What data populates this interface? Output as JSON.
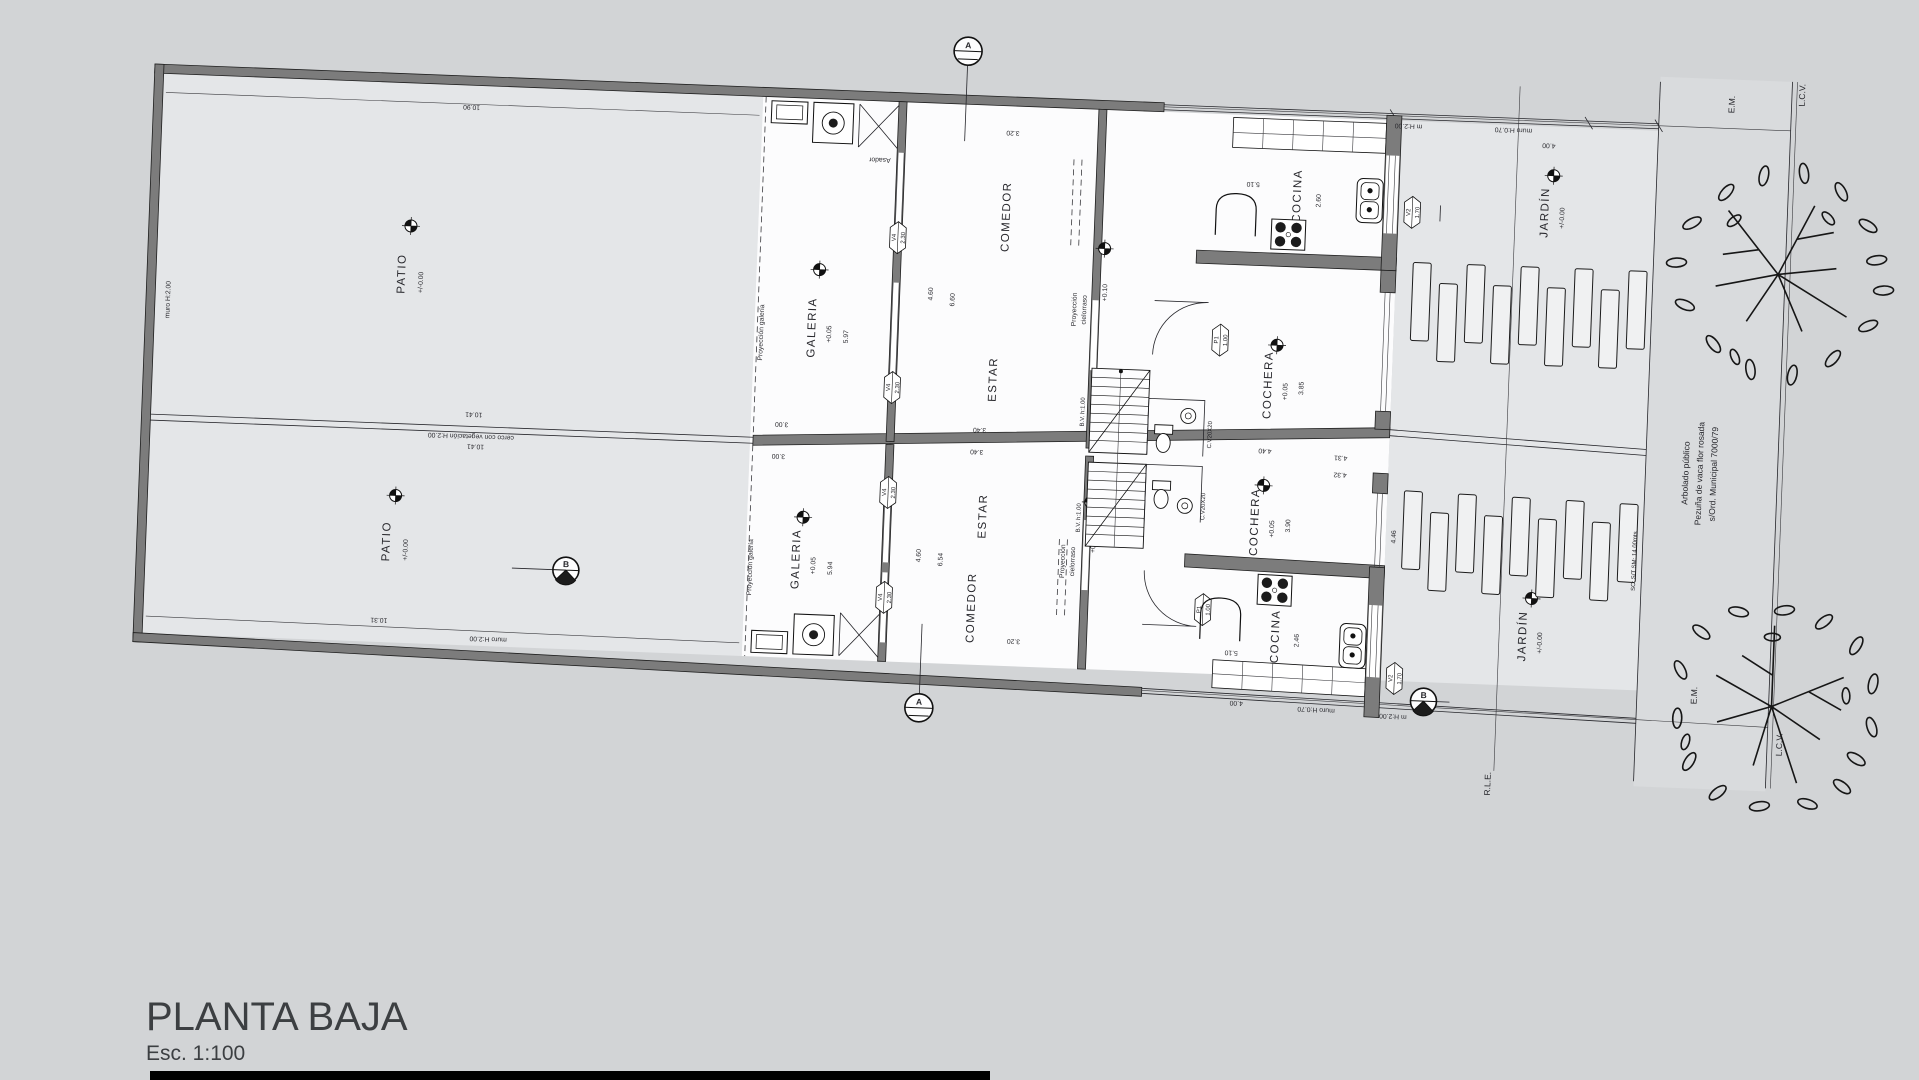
{
  "colors": {
    "background": "#d2d4d6",
    "paper": "#fcfcfd",
    "patio_fill": "#e4e6e8",
    "sidewalk_fill": "#d9dbdd",
    "wall": "#7c7c7c",
    "line": "#26262b"
  },
  "titleblock": {
    "title": "PLANTA BAJA",
    "scale": "Esc. 1:100"
  },
  "t": {
    "patio1": "PATIO",
    "patio2": "PATIO",
    "patio1_lvl": "+/-0.00",
    "patio2_lvl": "+/-0.00",
    "muro_left": "muro H:2.00",
    "muro_bottom": "muro H:2.00",
    "cerco": "cerco con vegetación H:2.00",
    "d1090": "10.90",
    "d1041a": "10.41",
    "d1041b": "10.41",
    "d1031": "10.31",
    "proy_gal1": "Proyección galería",
    "proy_gal2": "Proyección galería",
    "galeria1": "GALERIA",
    "galeria2": "GALERIA",
    "gal1_lvl": "+0.05",
    "gal2_lvl": "+0.05",
    "d597": "5.97",
    "d594": "5.94",
    "d300a": "3.00",
    "d300b": "3.00",
    "asador": "Asador",
    "comedor1": "COMEDOR",
    "comedor2": "COMEDOR",
    "estar1": "ESTAR",
    "estar2": "ESTAR",
    "d320a": "3.20",
    "d320b": "3.20",
    "d660": "6.60",
    "d654": "6.54",
    "d460a": "4.60",
    "d460b": "4.60",
    "proy_c1a": "Proyección",
    "proy_c1b": "cielorraso",
    "proy_c2a": "Proyección",
    "proy_c2b": "cielorraso",
    "d010a": "+0.10",
    "d010b": "+0.10",
    "bv1": "B.V. h:1.00",
    "bv2": "B.V. h:1.00",
    "cv1": "C.V20X20",
    "cv2": "C.V20X20",
    "d340a": "3.40",
    "d340b": "3.40",
    "cocina1": "COCINA",
    "cocina2": "COCINA",
    "d510a": "5.10",
    "d510b": "5.10",
    "d260": "2.60",
    "d246": "2.46",
    "cochera1": "COCHERA",
    "cochera2": "COCHERA",
    "coch1_lvl": "+0.05",
    "coch2_lvl": "+0.05",
    "d385": "3.85",
    "d390": "3.90",
    "d440": "4.40",
    "d431": "4.31",
    "d432": "4.32",
    "d446": "4.46",
    "jardin1": "JARDÍN",
    "jardin2": "JARDÍN",
    "jar1_lvl": "+/-0.00",
    "jar2_lvl": "+/-0.00",
    "d400a": "4.00",
    "d400b": "4.00",
    "fence_top_a": "m H:2.00",
    "fence_top_b": "muro H:0.70",
    "fence_bot_a": "m H:2.00",
    "fence_bot_b": "muro H:0.70",
    "sc": "SC: S/T SM: 14.00mts",
    "arb1": "Arbolado público",
    "arb2": "Pezuña de vaca flor rosada",
    "arb3": "s/Ord. Municipal 7000/79",
    "rle": "R.L.E.",
    "em_t": "E.M.",
    "em_b": "E.M.",
    "lcv_t": "L.C.V.",
    "lcv_b": "L.C.V.",
    "hx_p1a": "P1",
    "hx_p1a_v": "1.00",
    "hx_p1b": "P1",
    "hx_p1b_v": "1.00",
    "hx_v2a": "V2",
    "hx_v2a_v": "1.70",
    "hx_v2b": "V2",
    "hx_v2b_v": "1.70",
    "hx_v4a": "V4",
    "hx_v4a_v": "2.30",
    "hx_v4b": "V4",
    "hx_v4b_v": "2.30",
    "hx_v4c": "V4",
    "hx_v4c_v": "2.30",
    "hx_v4d": "V4",
    "hx_v4d_v": "2.30",
    "secA1": "A",
    "secA2": "A",
    "secB1": "B",
    "secB2": "B"
  }
}
